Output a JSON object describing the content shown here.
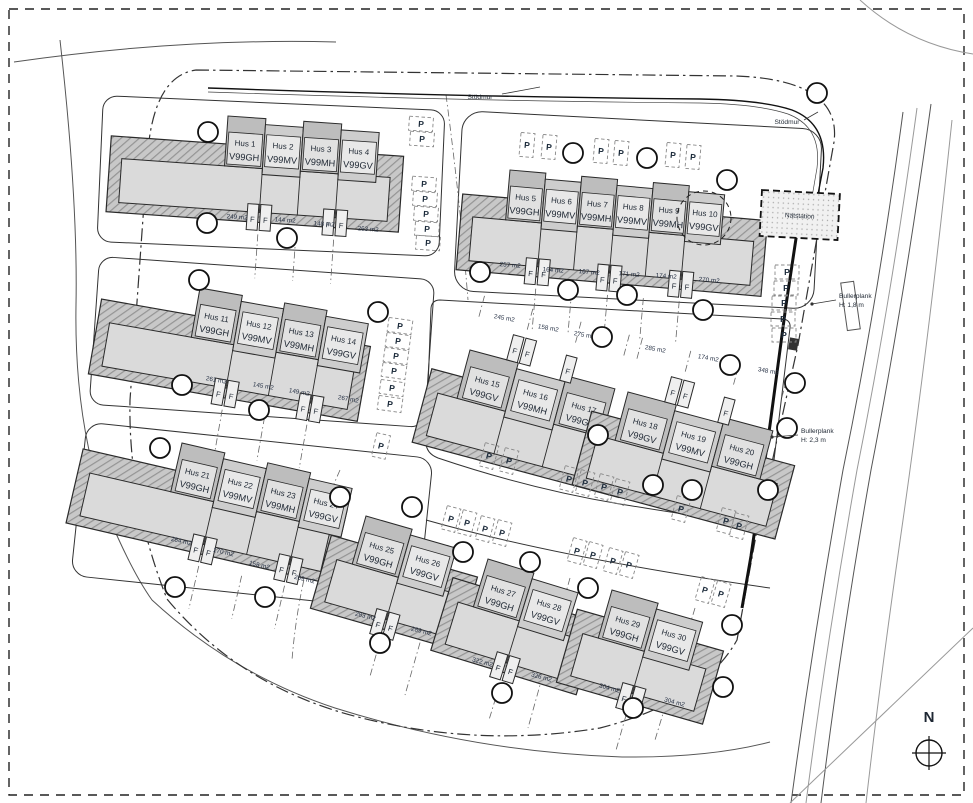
{
  "drawing": {
    "parking_label": "P",
    "storage_label": "F",
    "annotations": {
      "stodmur": "Stödmur",
      "natstation": "Nätstation",
      "bullerplank_18": {
        "title": "Bullerplank",
        "height": "H: 1,8 m"
      },
      "bullerplank_23": {
        "title": "Bullerplank",
        "height": "H: 2,3 m"
      },
      "north": "N"
    },
    "colors": {
      "building_dark": "#bdbdbd",
      "building_light": "#dadada",
      "slab_hatch": "#c8c8c8",
      "line": "#2a2a2a",
      "text": "#1e2733"
    },
    "blocks": [
      {
        "id": "hus-1-4",
        "units": [
          {
            "name": "Hus 1",
            "model": "V99GH"
          },
          {
            "name": "Hus 2",
            "model": "V99MV"
          },
          {
            "name": "Hus 3",
            "model": "V99MH"
          },
          {
            "name": "Hus 4",
            "model": "V99GV"
          }
        ],
        "areas": [
          "249 m2",
          "144 m2",
          "148 m2",
          "263 m2"
        ]
      },
      {
        "id": "hus-5-10",
        "units": [
          {
            "name": "Hus 5",
            "model": "V99GH"
          },
          {
            "name": "Hus 6",
            "model": "V99MV"
          },
          {
            "name": "Hus 7",
            "model": "V99MH"
          },
          {
            "name": "Hus 8",
            "model": "V99MV"
          },
          {
            "name": "Hus 9",
            "model": "V99MH"
          },
          {
            "name": "Hus 10",
            "model": "V99GV"
          }
        ],
        "areas": [
          "257 m2",
          "164 m2",
          "167 m2",
          "171 m2",
          "174 m2",
          "270 m2"
        ]
      },
      {
        "id": "hus-11-14",
        "units": [
          {
            "name": "Hus 11",
            "model": "V99GH"
          },
          {
            "name": "Hus 12",
            "model": "V99MV"
          },
          {
            "name": "Hus 13",
            "model": "V99MH"
          },
          {
            "name": "Hus 14",
            "model": "V99GV"
          }
        ],
        "areas": [
          "261 m2",
          "145 m2",
          "149 m2",
          "267 m2"
        ]
      },
      {
        "id": "hus-15-17",
        "units": [
          {
            "name": "Hus 15",
            "model": "V99GV"
          },
          {
            "name": "Hus 16",
            "model": "V99MH"
          },
          {
            "name": "Hus 17",
            "model": "V99GH"
          }
        ],
        "areas": [
          "245 m2",
          "158 m2",
          "275 m2"
        ]
      },
      {
        "id": "hus-18-20",
        "units": [
          {
            "name": "Hus 18",
            "model": "V99GV"
          },
          {
            "name": "Hus 19",
            "model": "V99MV"
          },
          {
            "name": "Hus 20",
            "model": "V99GH"
          }
        ],
        "areas": [
          "285 m2",
          "174 m2",
          "348 m2"
        ]
      },
      {
        "id": "hus-21-24",
        "units": [
          {
            "name": "Hus 21",
            "model": "V99GH"
          },
          {
            "name": "Hus 22",
            "model": "V99MV"
          },
          {
            "name": "Hus 23",
            "model": "V99MH"
          },
          {
            "name": "Hus 24",
            "model": "V99GV"
          }
        ],
        "areas": [
          "284 m2",
          "170 m2",
          "158 m2",
          "269 m2"
        ]
      },
      {
        "id": "hus-25-26",
        "units": [
          {
            "name": "Hus 25",
            "model": "V99GH"
          },
          {
            "name": "Hus 26",
            "model": "V99GV"
          }
        ],
        "areas": [
          "283 m2",
          "289 m2"
        ]
      },
      {
        "id": "hus-27-28",
        "units": [
          {
            "name": "Hus 27",
            "model": "V99GH"
          },
          {
            "name": "Hus 28",
            "model": "V99GV"
          }
        ],
        "areas": [
          "322 m2",
          "326 m2"
        ]
      },
      {
        "id": "hus-29-30",
        "units": [
          {
            "name": "Hus 29",
            "model": "V99GH"
          },
          {
            "name": "Hus 30",
            "model": "V99GV"
          }
        ],
        "areas": [
          "304 m2",
          "304 m2"
        ]
      }
    ]
  }
}
